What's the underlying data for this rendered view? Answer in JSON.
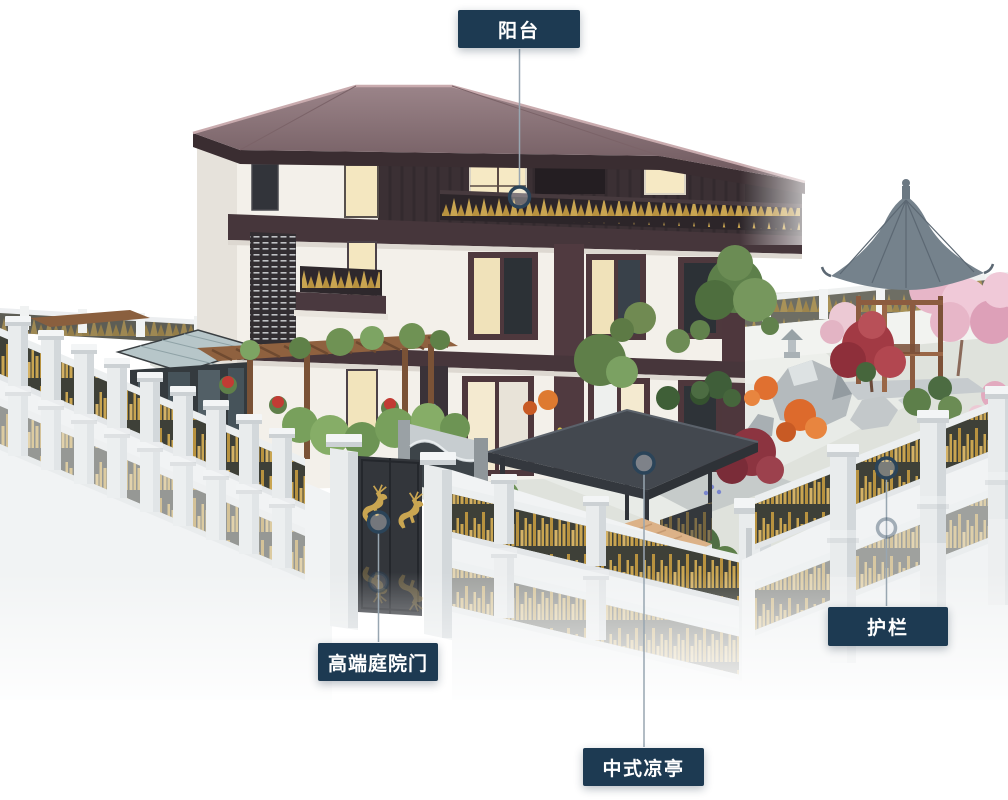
{
  "annotations": {
    "balcony": {
      "label": "阳台"
    },
    "courtyard_gate": {
      "label": "高端庭院门"
    },
    "pavilion": {
      "label": "中式凉亭"
    },
    "guardrail": {
      "label": "护栏"
    }
  },
  "theme": {
    "label_background": "#1d3a52",
    "label_text": "#ffffff",
    "callout_line": "#98a6b1",
    "marker_ring": "#2b4459",
    "background": "#ffffff"
  },
  "scene_palette": {
    "roof": "#8a7176",
    "wall": "#f3f0ea",
    "wood_trim": "#46363b",
    "fence_panel": "#3e4038",
    "fence_gold": "#c9a551",
    "pillar_white": "#eceef0",
    "gazebo_roof": "#75828c",
    "gazebo_wood": "#8c5c40",
    "pavilion_canopy": "#3c4148",
    "deck_wood": "#dcb288",
    "foliage_green": "#6b8c54",
    "maple_red": "#a23a44",
    "blossom_pink": "#e7b6c8",
    "rock_gray": "#b4babd"
  }
}
